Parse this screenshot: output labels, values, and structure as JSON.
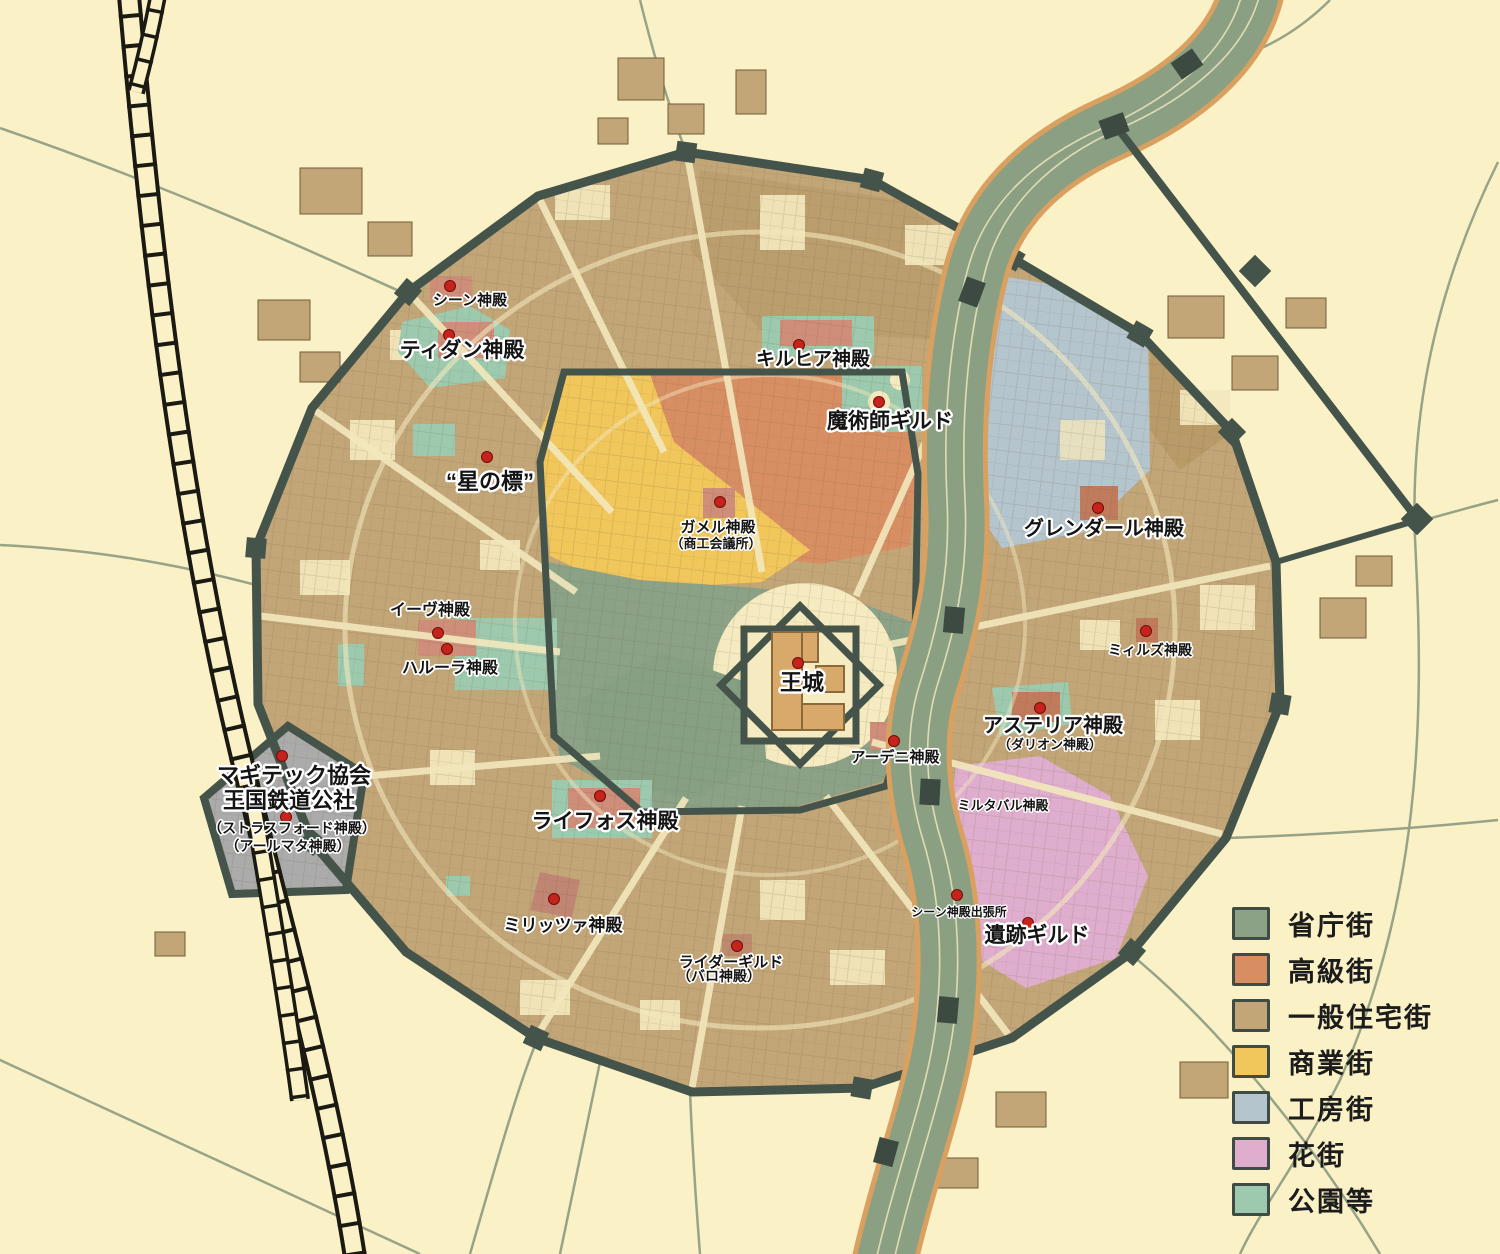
{
  "map": {
    "colors": {
      "background": "#FBF1C6",
      "wall": "#45544B",
      "river_water": "#8BA083",
      "river_bank": "#D9A05F",
      "road_cream": "#F3E8BD",
      "road_faint": "#8C9B80",
      "railroad": "#1A1A12",
      "magitech_area": "#ABABAB",
      "temple_building": "#CE8E7A",
      "marker_red": "#C5231B"
    },
    "labels": [
      {
        "id": "shien-temple",
        "text": "シーン神殿",
        "x": 470,
        "y": 305,
        "fs": 15
      },
      {
        "id": "tidan-temple",
        "text": "ティダン神殿",
        "x": 462,
        "y": 357,
        "fs": 21
      },
      {
        "id": "kirhia-temple",
        "text": "キルヒア神殿",
        "x": 813,
        "y": 365,
        "fs": 19
      },
      {
        "id": "mage-guild",
        "text": "魔術師ギルド",
        "x": 890,
        "y": 428,
        "fs": 21
      },
      {
        "id": "hoshi-no-shirube",
        "text": "“星の標”",
        "x": 490,
        "y": 489,
        "fs": 22
      },
      {
        "id": "gamel-temple",
        "text": "ガメル神殿",
        "x": 718,
        "y": 532,
        "fs": 15
      },
      {
        "id": "chamber-of-commerce",
        "text": "（商工会議所）",
        "x": 716,
        "y": 548,
        "fs": 13
      },
      {
        "id": "grendal-temple",
        "text": "グレンダール神殿",
        "x": 1104,
        "y": 535,
        "fs": 20
      },
      {
        "id": "eve-temple",
        "text": "イーヴ神殿",
        "x": 430,
        "y": 615,
        "fs": 16
      },
      {
        "id": "harula-temple",
        "text": "ハルーラ神殿",
        "x": 450,
        "y": 673,
        "fs": 16
      },
      {
        "id": "royal-castle",
        "text": "王城",
        "x": 802,
        "y": 690,
        "fs": 22
      },
      {
        "id": "meelz-temple",
        "text": "ミィルズ神殿",
        "x": 1150,
        "y": 655,
        "fs": 14
      },
      {
        "id": "asteria-temple",
        "text": "アステリア神殿",
        "x": 1053,
        "y": 732,
        "fs": 20
      },
      {
        "id": "dalion-temple",
        "text": "（ダリオン神殿）",
        "x": 1050,
        "y": 749,
        "fs": 13
      },
      {
        "id": "adeni-temple",
        "text": "アーデニ神殿",
        "x": 895,
        "y": 762,
        "fs": 15
      },
      {
        "id": "magitech-association",
        "text": "マギテック協会",
        "x": 294,
        "y": 783,
        "fs": 22
      },
      {
        "id": "royal-railway-corp",
        "text": "王国鉄道公社",
        "x": 289,
        "y": 808,
        "fs": 22
      },
      {
        "id": "strasford-temple",
        "text": "（ストラスフォード神殿）",
        "x": 292,
        "y": 833,
        "fs": 14
      },
      {
        "id": "armata-temple",
        "text": "（アールマタ神殿）",
        "x": 288,
        "y": 851,
        "fs": 14
      },
      {
        "id": "lyphos-temple",
        "text": "ライフォス神殿",
        "x": 605,
        "y": 828,
        "fs": 21
      },
      {
        "id": "miltabal-temple",
        "text": "ミルタバル神殿",
        "x": 1003,
        "y": 810,
        "fs": 13
      },
      {
        "id": "miritza-temple",
        "text": "ミリッツァ神殿",
        "x": 563,
        "y": 931,
        "fs": 17
      },
      {
        "id": "shien-branch",
        "text": "シーン神殿出張所",
        "x": 959,
        "y": 916,
        "fs": 12
      },
      {
        "id": "ruins-guild",
        "text": "遺跡ギルド",
        "x": 1037,
        "y": 942,
        "fs": 21
      },
      {
        "id": "rider-guild",
        "text": "ライダーギルド",
        "x": 731,
        "y": 967,
        "fs": 15
      },
      {
        "id": "balo-temple",
        "text": "（バロ神殿）",
        "x": 719,
        "y": 981,
        "fs": 14
      }
    ],
    "markers": [
      {
        "x": 450,
        "y": 286
      },
      {
        "x": 449,
        "y": 335
      },
      {
        "x": 799,
        "y": 345
      },
      {
        "x": 879,
        "y": 402
      },
      {
        "x": 487,
        "y": 457
      },
      {
        "x": 720,
        "y": 502
      },
      {
        "x": 1098,
        "y": 508
      },
      {
        "x": 438,
        "y": 633
      },
      {
        "x": 447,
        "y": 649
      },
      {
        "x": 798,
        "y": 663
      },
      {
        "x": 1146,
        "y": 631
      },
      {
        "x": 1040,
        "y": 708
      },
      {
        "x": 894,
        "y": 741
      },
      {
        "x": 282,
        "y": 756
      },
      {
        "x": 286,
        "y": 817
      },
      {
        "x": 600,
        "y": 796
      },
      {
        "x": 554,
        "y": 899
      },
      {
        "x": 957,
        "y": 895
      },
      {
        "x": 1028,
        "y": 923
      },
      {
        "x": 737,
        "y": 946
      }
    ]
  },
  "legend": {
    "items": [
      {
        "label": "省庁街",
        "color": "#8BA287"
      },
      {
        "label": "高級街",
        "color": "#D88E63"
      },
      {
        "label": "一般住宅街",
        "color": "#C2A678"
      },
      {
        "label": "商業街",
        "color": "#F1C65B"
      },
      {
        "label": "工房街",
        "color": "#B4C5CE"
      },
      {
        "label": "花街",
        "color": "#DFAECE"
      },
      {
        "label": "公園等",
        "color": "#9DCAAE"
      }
    ]
  }
}
